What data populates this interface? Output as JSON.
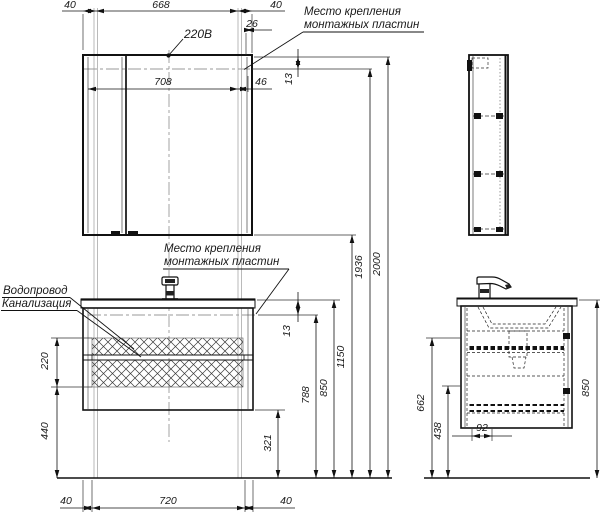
{
  "drawing": {
    "labels": {
      "power": "220В",
      "mounting_plates_line1": "Место крепления",
      "mounting_plates_line2": "монтажных пластин",
      "water_supply": "Водопровод",
      "sewerage": "Канализация"
    },
    "dims": {
      "top_left_offset": "40",
      "top_span": "668",
      "top_right_offset": "40",
      "top_right_inset": "26",
      "plates_span": "708",
      "plates_right_offset": "46",
      "mirror_plate_gap": "13",
      "vanity_plate_gap": "13",
      "hatch_height": "220",
      "hatch_to_floor": "440",
      "cabinet_bottom_height": "321",
      "plate_height": "788",
      "counter_height": "850",
      "mirror_bottom_height": "1150",
      "mirror_plate_height": "1936",
      "mirror_top_height": "2000",
      "bottom_left_offset": "40",
      "bottom_span": "720",
      "bottom_right_offset": "40",
      "side_upper_height": "662",
      "side_lower_height": "438",
      "drain_offset": "92",
      "side_counter_height": "850"
    }
  }
}
